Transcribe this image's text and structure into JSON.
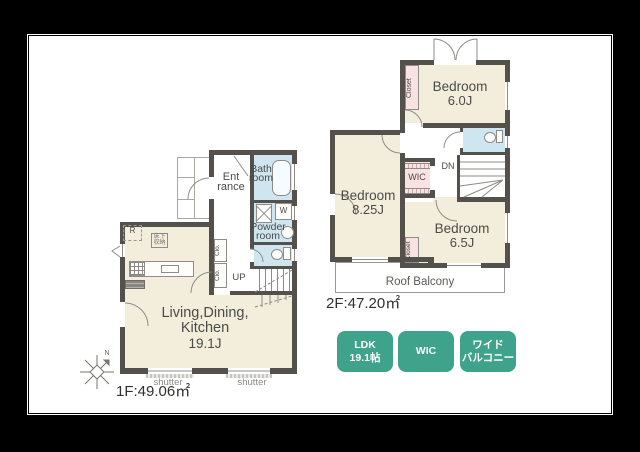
{
  "colors": {
    "bg": "#000000",
    "wall": "#54514d",
    "room": "#f3eedb",
    "wet": "#cfe5f0",
    "closet": "#f8e3e2",
    "badge": "#3ea38a",
    "line": "#8e8c88",
    "text": "#4b4a48"
  },
  "floor1": {
    "area_label": "1F:49.06㎡",
    "ldk_line1": "Living,Dining,",
    "ldk_line2": "Kitchen",
    "ldk_size": "19.1J",
    "entrance_line1": "Ent",
    "entrance_line2": "rance",
    "bath_line1": "Bath",
    "bath_line2": "room",
    "powder_line1": "Powder",
    "powder_line2": "room",
    "washer": "W",
    "fridge": "R",
    "storage_line1": "床下",
    "storage_line2": "収納",
    "closet_a": "Clo.",
    "closet_b": "Clo.",
    "up": "UP",
    "shutter_left": "shutter",
    "shutter_right": "shutter"
  },
  "floor2": {
    "area_label": "2F:47.20㎡",
    "bedroom1_name": "Bedroom",
    "bedroom1_size": "6.0J",
    "bedroom2_name": "Bedroom",
    "bedroom2_size": "8.25J",
    "bedroom3_name": "Bedroom",
    "bedroom3_size": "6.5J",
    "wic": "WIC",
    "closet_top": "Closet",
    "closet_bottom": "Closet",
    "dn": "DN",
    "balcony": "Roof Balcony"
  },
  "compass": {
    "north": "N"
  },
  "badges": [
    {
      "line1": "LDK",
      "line2": "19.1帖"
    },
    {
      "line1": "WIC",
      "line2": ""
    },
    {
      "line1": "ワイド",
      "line2": "バルコニー"
    }
  ]
}
